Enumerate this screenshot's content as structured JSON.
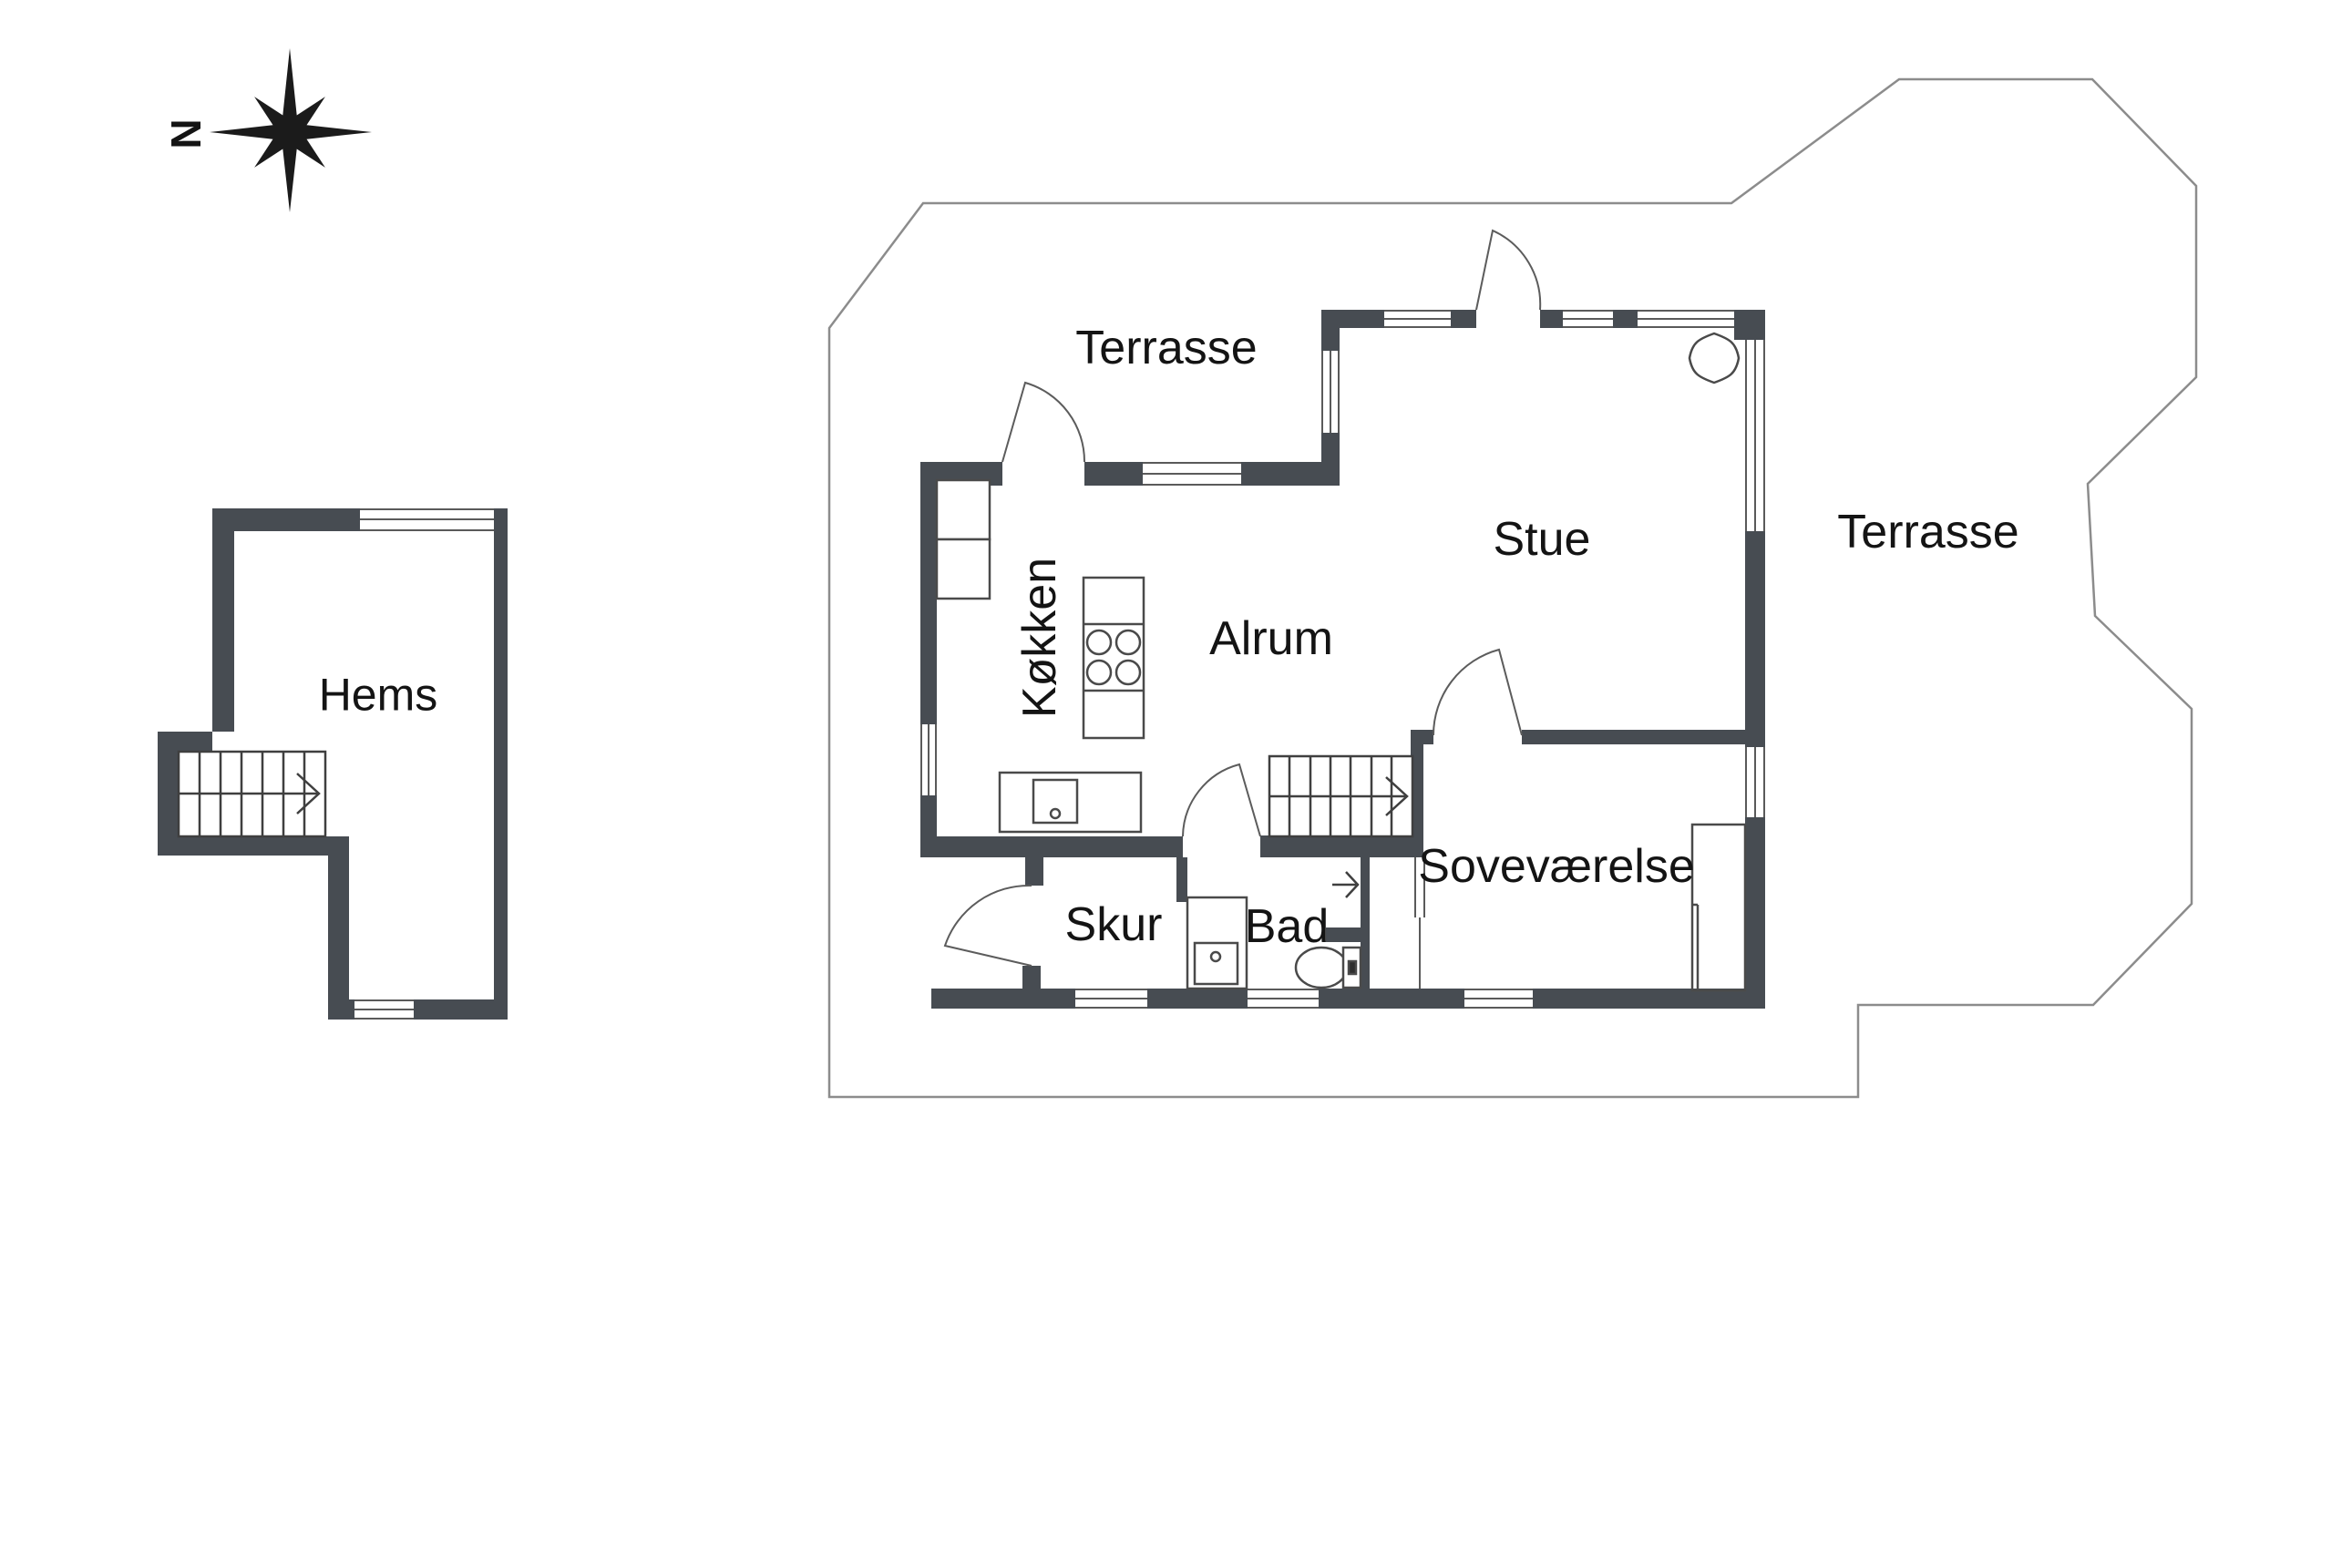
{
  "compass": {
    "north_label": "N"
  },
  "rooms": {
    "hems": "Hems",
    "terrasse_top": "Terrasse",
    "terrasse_right": "Terrasse",
    "stue": "Stue",
    "alrum": "Alrum",
    "kitchen": "Køkken",
    "bedroom": "Soveværelse",
    "shed": "Skur",
    "bath": "Bad"
  },
  "colors": {
    "wall": "#474c52",
    "furniture_line": "#4a4a4a",
    "outline_line": "#8c8c8c",
    "window_line": "#5a5a5a",
    "text": "#141414"
  }
}
